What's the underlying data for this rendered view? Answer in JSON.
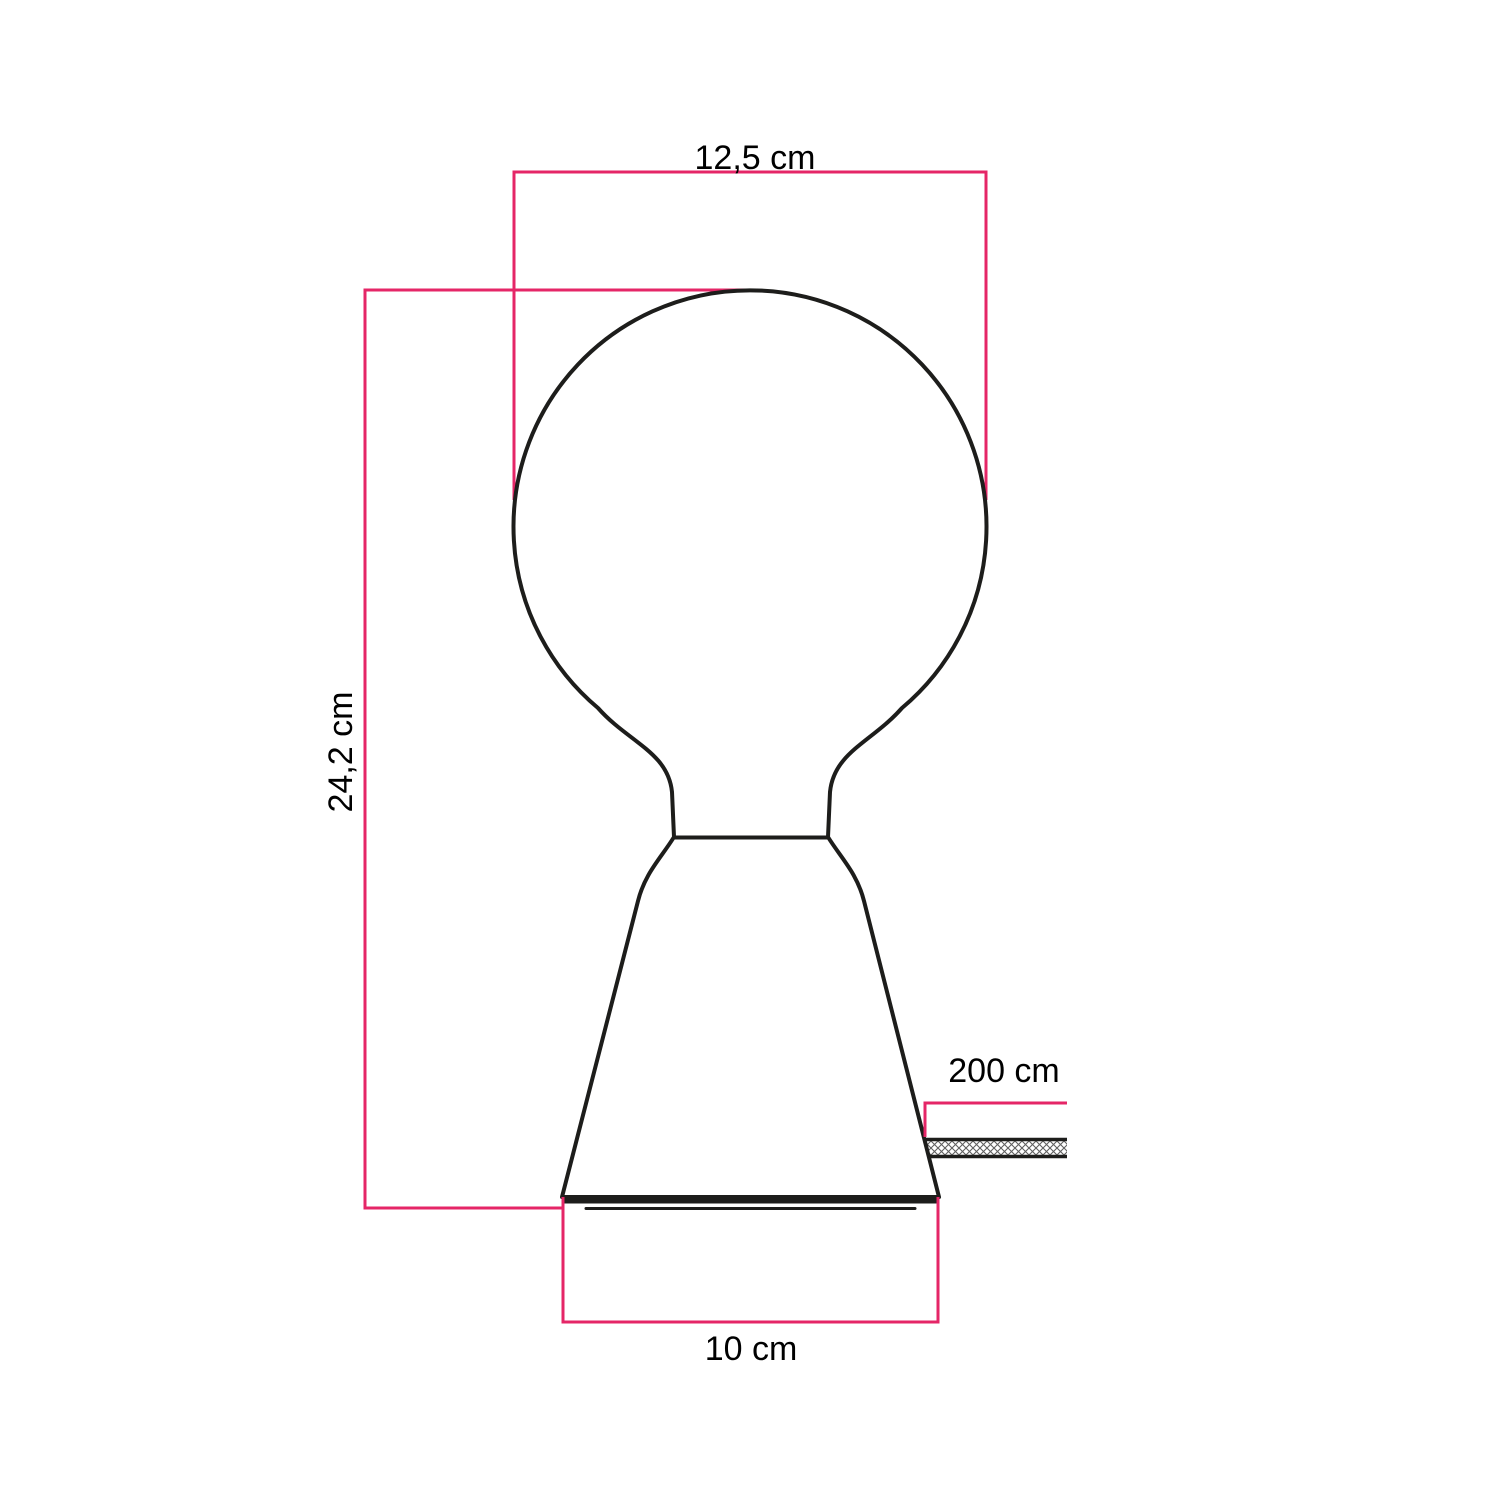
{
  "diagram": {
    "labels": {
      "bulb_width": "12,5 cm",
      "total_height": "24,2 cm",
      "cable_length": "200 cm",
      "base_width": "10 cm"
    },
    "colors": {
      "dimension_pink": "#e52667",
      "outline_black": "#1d1d1b",
      "hatch_gray": "#606060",
      "background": "#ffffff"
    }
  }
}
